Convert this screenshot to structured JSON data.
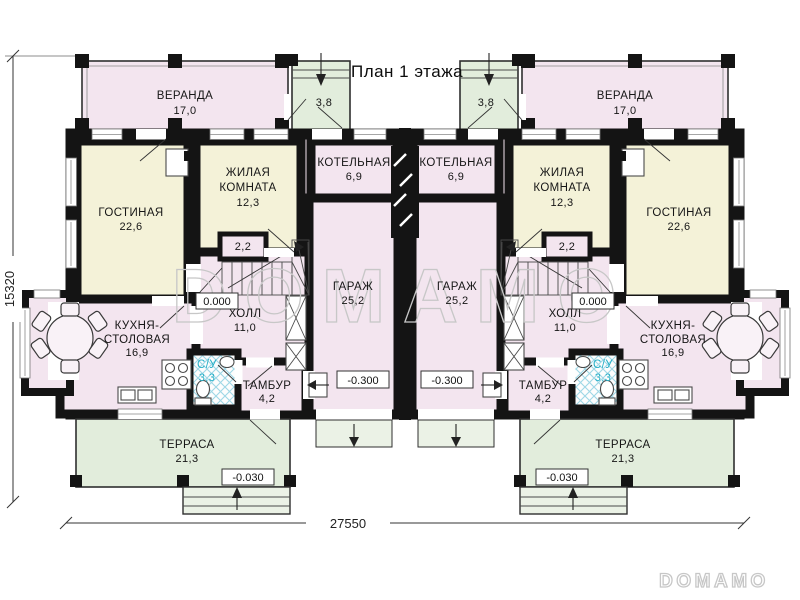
{
  "title": "План 1 этажа",
  "watermark": {
    "center": "DOMAMO",
    "corner": "DOMAMO"
  },
  "dimensions": {
    "width_mm": "27550",
    "height_mm": "15320"
  },
  "levels": {
    "zero": "0.000",
    "garage": "-0.300",
    "terrace": "-0.030"
  },
  "rooms": {
    "veranda": {
      "name": "ВЕРАНДА",
      "area": "17,0"
    },
    "porch": {
      "area": "3,8"
    },
    "living_room": {
      "name": "ГОСТИНАЯ",
      "area": "22,6"
    },
    "bedroom": {
      "line1": "ЖИЛАЯ",
      "line2": "КОМНАТА",
      "area": "12,3"
    },
    "boiler": {
      "name": "КОТЕЛЬНАЯ",
      "area": "6,9"
    },
    "garage": {
      "name": "ГАРАЖ",
      "area": "25,2"
    },
    "stair_closet": {
      "area": "2,2"
    },
    "hall": {
      "name": "ХОЛЛ",
      "area": "11,0"
    },
    "kitchen": {
      "line1": "КУХНЯ-",
      "line2": "СТОЛОВАЯ",
      "area": "16,9"
    },
    "wc": {
      "name": "С/У",
      "area": "3,3"
    },
    "tambour": {
      "name": "ТАМБУР",
      "area": "4,2"
    },
    "terrace": {
      "name": "ТЕРРАСА",
      "area": "21,3"
    }
  },
  "colors": {
    "wall": "#141414",
    "room_pink": "#f3e5ef",
    "room_cream": "#f4f2d8",
    "outdoor_green": "#e2eddc",
    "steps_green": "#ebf2e6",
    "wc_text": "#25b0c7",
    "watermark": "#c7c7c7"
  }
}
